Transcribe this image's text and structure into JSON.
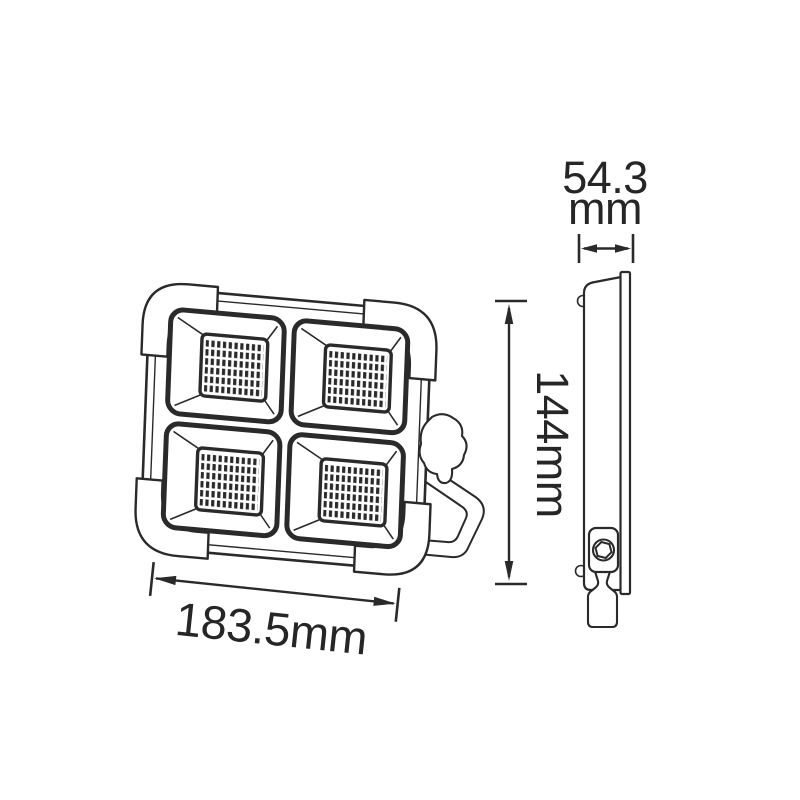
{
  "page": {
    "background": "#ffffff",
    "line_color": "#2a2a2a",
    "text_color": "#262626"
  },
  "diagram": {
    "subject": "led-work-floodlight-dimension-drawing",
    "views": {
      "front": {
        "name": "front-view",
        "led_modules": 4,
        "led_grid": {
          "rows": 6,
          "cols": 10
        }
      },
      "side": {
        "name": "side-view"
      }
    },
    "dimensions": {
      "depth": {
        "value": "54.3",
        "unit": "mm"
      },
      "height": {
        "label": "144mm"
      },
      "width": {
        "label": "183.5mm"
      }
    }
  }
}
